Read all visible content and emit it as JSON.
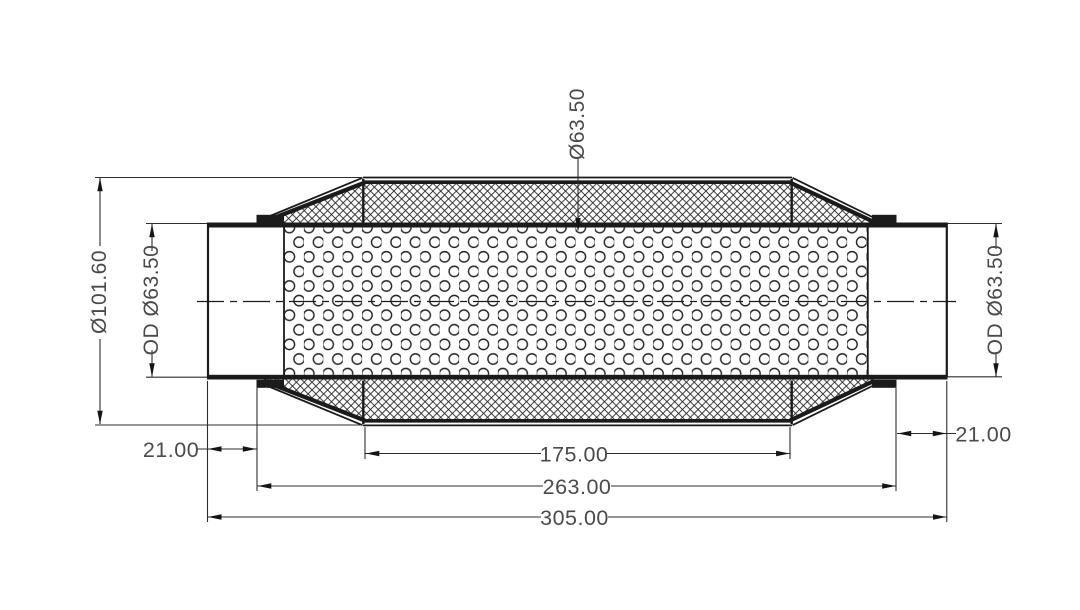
{
  "drawing": {
    "type": "technical-drawing",
    "view": "section-view-muffler",
    "colors": {
      "background": "#ffffff",
      "object_line": "#1a1a1a",
      "thick_section": "#1b1b1b",
      "dimension_line": "#2d2d2d",
      "arrow": "#141414",
      "text": "#4a4a4a"
    },
    "dims": {
      "overall_diameter": "Ø101.60",
      "inlet_od": "OD Ø63.50",
      "core_diameter": "Ø63.50",
      "outlet_od": "OD Ø63.50",
      "inlet_length": "21.00",
      "outlet_length": "21.00",
      "perforated_length": "175.00",
      "body_length": "263.00",
      "overall_length": "305.00"
    }
  }
}
